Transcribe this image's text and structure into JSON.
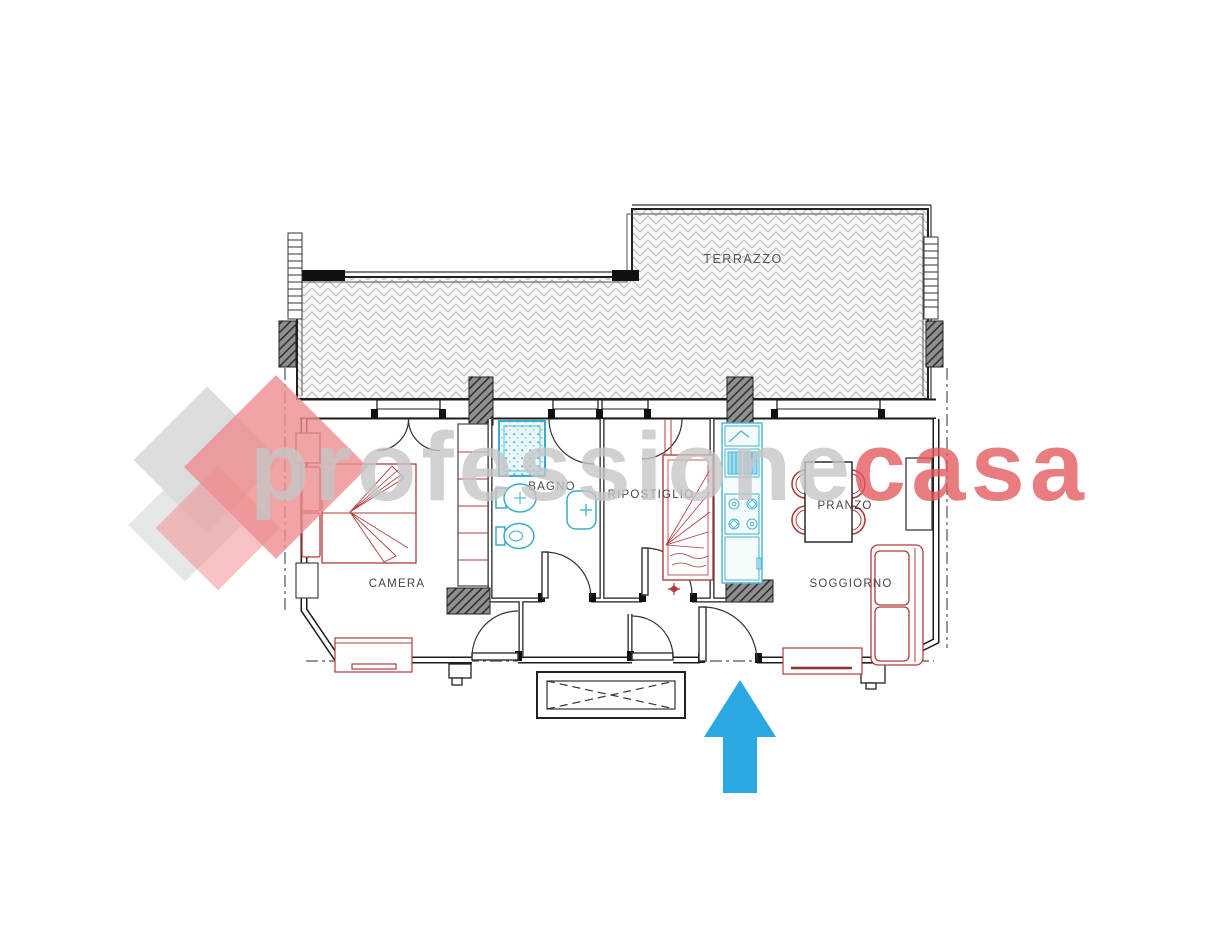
{
  "rooms": {
    "terrazzo": {
      "label": "TERRAZZO"
    },
    "camera": {
      "label": "CAMERA"
    },
    "bagno": {
      "label": "BAGNO"
    },
    "ripostiglio": {
      "label": "RIPOSTIGLIO"
    },
    "pranzo": {
      "label": "PRANZO"
    },
    "soggiorno": {
      "label": "SOGGIORNO"
    }
  },
  "watermark": {
    "text_gray": "professione",
    "text_red": "casa",
    "gray_hex": "#c6c6c6",
    "red_hex": "#e2575b"
  },
  "entrance_arrow": {
    "direction": "up",
    "color_hex": "#29a8e1"
  },
  "plan_colors": {
    "walls": "#1c1c1c",
    "furniture_red": "#b23b3b",
    "fixtures_cyan": "#3aabcc",
    "terrace_hatch": "#b8b8b8"
  }
}
